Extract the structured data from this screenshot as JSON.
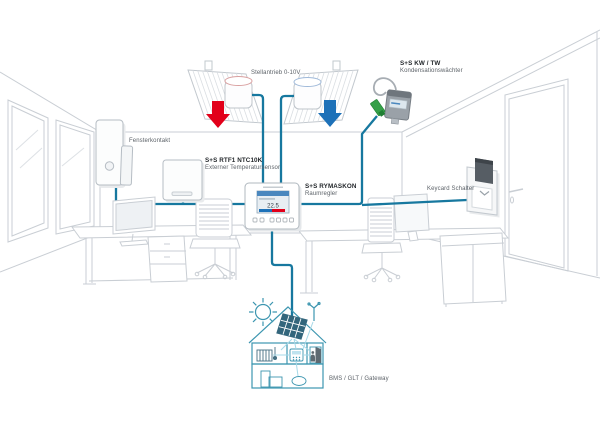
{
  "diagram": {
    "actuators": {
      "label": "Stellantrieb 0-10V"
    },
    "condensation": {
      "name": "S+S KW / TW",
      "type": "Kondensationswächter"
    },
    "window_contact": {
      "label": "Fensterkontakt"
    },
    "temp_sensor": {
      "name": "S+S RTF1 NTC10K",
      "type": "Externer Temperatursensor"
    },
    "controller": {
      "name": "S+S RYMASKON",
      "type": "Raumregler",
      "display": "22.5"
    },
    "keycard": {
      "label": "Keycard Schalter"
    },
    "gateway": {
      "label": "BMS / GLT / Gateway"
    }
  },
  "colors": {
    "bus": "#17789F",
    "heat": "#E2001A",
    "cool": "#1D71B8",
    "house": "#3D96B0",
    "house_link": "#A6D9E8",
    "sketch": "#C9CED4",
    "screen_header": "#4A87BE"
  }
}
